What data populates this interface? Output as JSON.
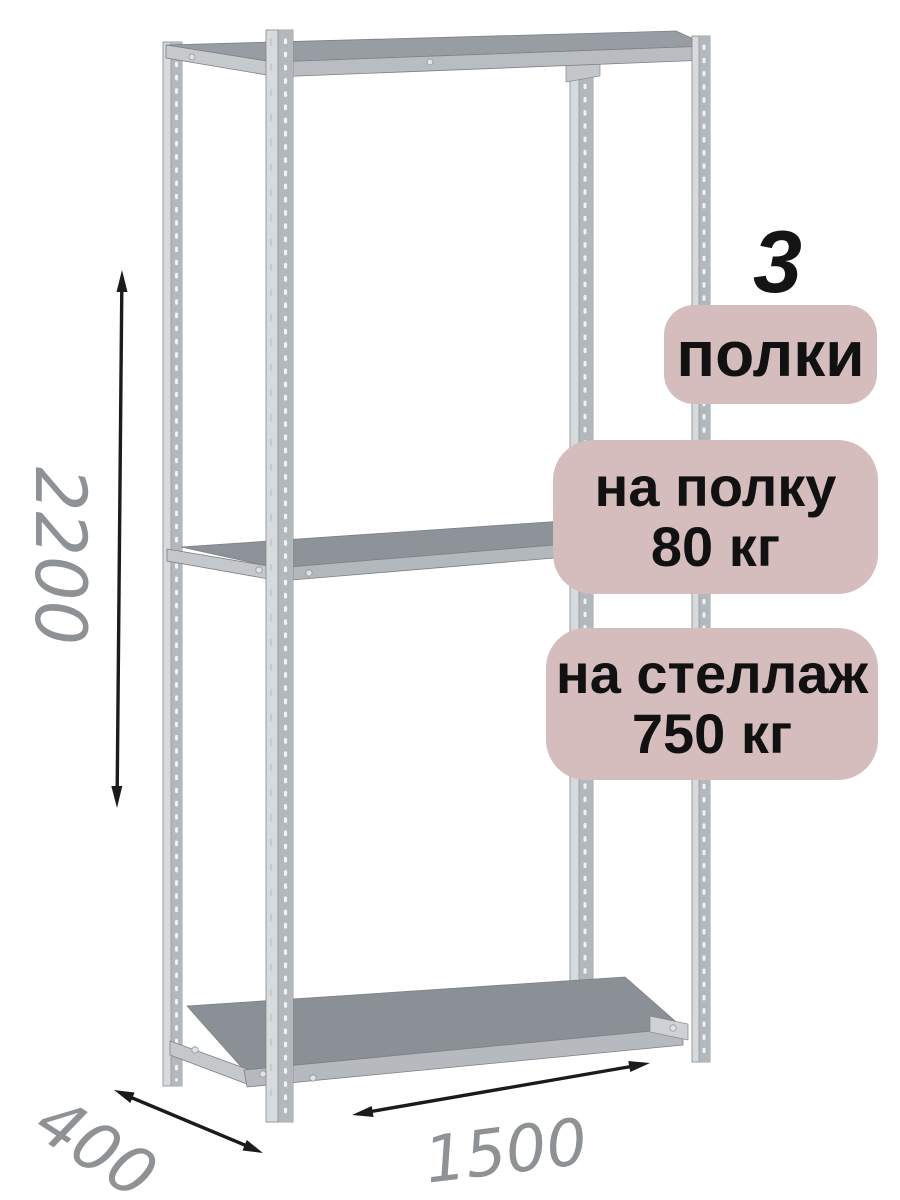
{
  "diagram": {
    "type": "product-dimension-diagram",
    "subject": "metal-shelving-rack",
    "dimensions": {
      "height": {
        "value": "2200",
        "orientation": "vertical"
      },
      "depth": {
        "value": "400",
        "orientation": "diagonal"
      },
      "width": {
        "value": "1500",
        "orientation": "horizontal"
      }
    },
    "badges": {
      "count_number": "3",
      "count_label": "полки",
      "shelf_load_line1": "на полку",
      "shelf_load_line2": "80 кг",
      "rack_load_line1": "на стеллаж",
      "rack_load_line2": "750 кг"
    },
    "colors": {
      "background": "#ffffff",
      "badge_bg": "#d5bcbd",
      "badge_text": "#111111",
      "dimension_text": "#8e9295",
      "arrow": "#1b1b1b",
      "metal_light": "#d8dbdd",
      "metal_dark": "#b3b8bc",
      "shelf_top": "#8a9095"
    }
  }
}
